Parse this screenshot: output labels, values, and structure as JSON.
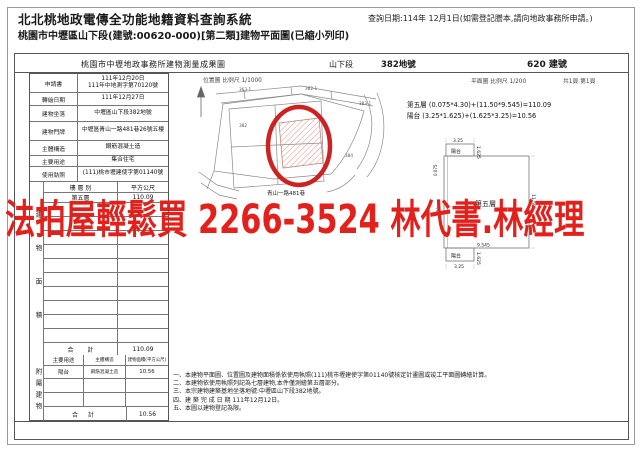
{
  "header": {
    "system_title": "北北桃地政電傳全功能地籍資料查詢系統",
    "query_date": "查詢日期:114年 12月1日(如需登記謄本,請向地政事務所申請。)",
    "subtitle": "桃園市中壢區山下段(建號:00620-000)[第二類]建物平面圖(已縮小列印)"
  },
  "doc": {
    "title": "桃園市中壢地政事務所建物測量成果圖",
    "section_name": "山下段",
    "land_number": "382地號",
    "building_number": "620 建號",
    "position_map_caption": "位置圖 比例尺 1/1000",
    "floor_plan_caption": "平面圖 比例尺 1/200",
    "page_caption": "共1頁 第1頁",
    "info_rows": [
      {
        "label": "申請書",
        "value": "111年12月20日",
        "value2": "111年中地測字第70120號"
      },
      {
        "label": "轉繪日期",
        "value": "111年12月27日"
      },
      {
        "label": "建物坐落",
        "value": "中壢區山下段382地號"
      },
      {
        "label": "建物門牌",
        "value": "中壢區青山一路481巷26號五樓"
      },
      {
        "label": "主體構造",
        "value": "鋼筋混凝土造"
      },
      {
        "label": "主要用途",
        "value": "集合住宅"
      },
      {
        "label": "使用執照",
        "value": "(111)桃市壢建使字第01140號"
      }
    ],
    "floor_area_table": {
      "side_label": "建物面積",
      "headers": [
        "樓 層 別",
        "平方公尺"
      ],
      "floor_name": "第五層",
      "floor_value": "110.09",
      "total_label": "合 計",
      "total_value": "110.09"
    },
    "annex_table": {
      "side_label": "附屬建物",
      "headers": [
        "主要用途",
        "主體構造",
        "建物面積(平方公尺)"
      ],
      "annex_name": "陽台",
      "annex_structure": "鋼筋混凝土造",
      "annex_value": "10.56",
      "total_label": "合 計",
      "total_value": "10.56"
    },
    "area_calculations": [
      "第五層 (0.075*4.30)+(11.50*9.545)=110.09",
      "陽台 (3.25*1.625)+(1.625*3.25)=10.56"
    ],
    "notes": [
      "一、本建物平面圖、位置圖及建物面積係依使用執照(111)桃市壢建使字第01140號核定計畫圖或竣工平面圖轉繪計算。",
      "二、本建物依使用執照列記為七層建物,本件僅測繪第五層部分。",
      "三、本宗建物建築基地坐落地號:中壢區山下段382地號。",
      "四、建 築 完 成 日 期 111年12月12日。",
      "五、本圖以建物登記為限。"
    ],
    "site_plan": {
      "road_label": "青山一路481巷",
      "lot_numbers": [
        "363-1",
        "382-1",
        "383-1",
        "382",
        "384"
      ],
      "highlight_color": "#cc2222"
    },
    "floor_plan": {
      "room_label": "第五層",
      "balcony_label": "陽台",
      "dim_width": "9.545",
      "dim_height": "11.50",
      "balcony_width": "3.25",
      "balcony_depth": "1.625",
      "dim_left_a": "0.075",
      "dim_left_b": "4.30"
    }
  },
  "overlay": {
    "text": "法拍屋輕鬆買  2266-3524  林代書.林經理",
    "color": "#e2211c"
  }
}
